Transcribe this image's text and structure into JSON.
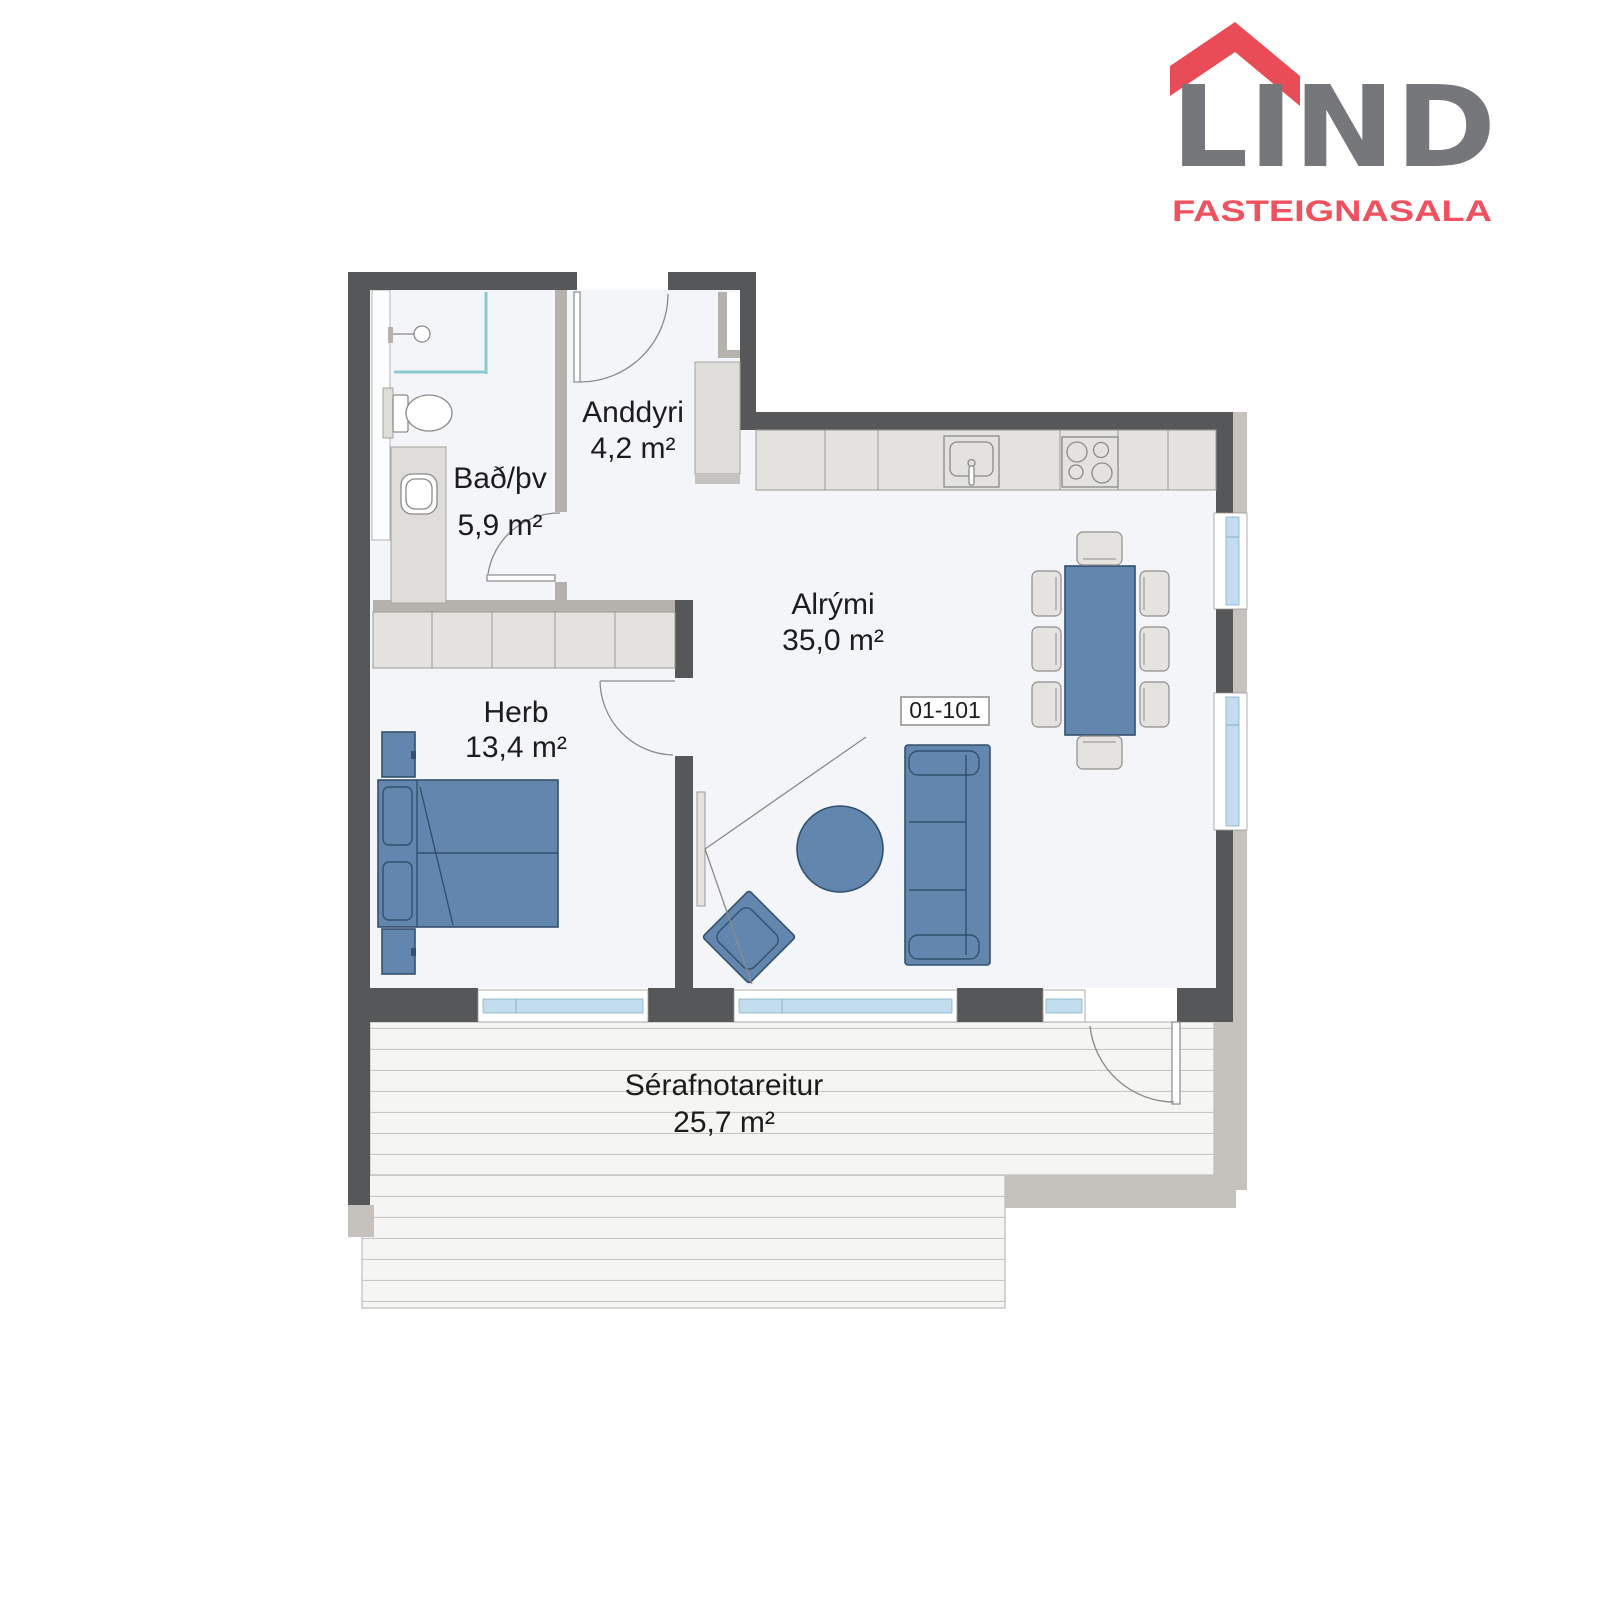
{
  "brand": {
    "name": "LIND",
    "tagline": "FASTEIGNASALA",
    "name_color": "#76777a",
    "roof_color": "#e94c57",
    "tagline_color": "#ef515e"
  },
  "unit": {
    "label": "01-101"
  },
  "rooms": [
    {
      "id": "bathroom",
      "name": "Bað/þv",
      "area": "5,9 m²"
    },
    {
      "id": "entrance",
      "name": "Anddyri",
      "area": "4,2 m²"
    },
    {
      "id": "living",
      "name": "Alrými",
      "area": "35,0 m²"
    },
    {
      "id": "bedroom",
      "name": "Herb",
      "area": "13,4 m²"
    },
    {
      "id": "terrace",
      "name": "Sérafnotareitur",
      "area": "25,7 m²"
    }
  ],
  "colors": {
    "exterior_wall": "#565758",
    "interior_wall": "#b5b2ad",
    "cladding": "#c5c2bd",
    "floor": "#f3f5f9",
    "deck": "#f5f5f3",
    "furniture_blue": "#6286ae",
    "furniture_outline": "#33516f",
    "cabinet_gray": "#e3e2de",
    "window_glass": "#c2ddee",
    "shower_glass": "#8ccbcd",
    "text": "#1c1c1c"
  }
}
